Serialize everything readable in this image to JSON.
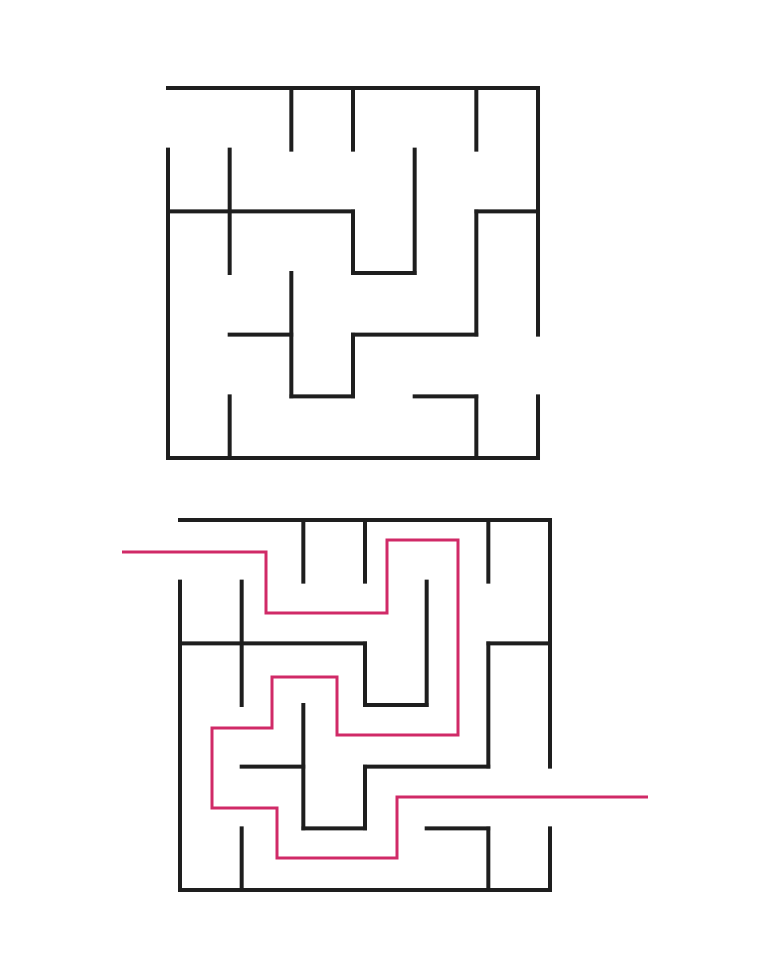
{
  "canvas": {
    "width": 758,
    "height": 980,
    "background": "#ffffff"
  },
  "maze": {
    "grid_cols": 6,
    "grid_rows": 6,
    "cell_size": 61.667,
    "pixel_size": 370,
    "wall_color": "#1e1e1e",
    "wall_width": 4,
    "entrance": "left-side-row-0",
    "exit": "right-side-row-4",
    "walls_grid": [
      [
        0,
        0,
        6,
        0
      ],
      [
        0,
        6,
        6,
        6
      ],
      [
        0,
        1,
        0,
        6
      ],
      [
        6,
        0,
        6,
        4
      ],
      [
        6,
        5,
        6,
        6
      ],
      [
        2,
        0,
        2,
        1
      ],
      [
        3,
        0,
        3,
        1
      ],
      [
        5,
        0,
        5,
        1
      ],
      [
        1,
        1,
        1,
        3
      ],
      [
        4,
        1,
        4,
        3
      ],
      [
        3,
        2,
        3,
        3
      ],
      [
        5,
        2,
        5,
        4
      ],
      [
        2,
        3,
        2,
        5
      ],
      [
        3,
        4,
        3,
        5
      ],
      [
        1,
        5,
        1,
        6
      ],
      [
        5,
        5,
        5,
        6
      ],
      [
        0,
        2,
        3,
        2
      ],
      [
        5,
        2,
        6,
        2
      ],
      [
        3,
        3,
        4,
        3
      ],
      [
        1,
        4,
        2,
        4
      ],
      [
        3,
        4,
        5,
        4
      ],
      [
        2,
        5,
        3,
        5
      ],
      [
        4,
        5,
        5,
        5
      ]
    ]
  },
  "mazes": {
    "unsolved": {
      "origin_x": 168,
      "origin_y": 88
    },
    "solved": {
      "origin_x": 180,
      "origin_y": 520
    }
  },
  "solution": {
    "color": "#d02a67",
    "width": 3,
    "points": [
      [
        122,
        552
      ],
      [
        266,
        552
      ],
      [
        266,
        613
      ],
      [
        387,
        613
      ],
      [
        387,
        540
      ],
      [
        458,
        540
      ],
      [
        458,
        735
      ],
      [
        337,
        735
      ],
      [
        337,
        677
      ],
      [
        272,
        677
      ],
      [
        272,
        728
      ],
      [
        212,
        728
      ],
      [
        212,
        808
      ],
      [
        277,
        808
      ],
      [
        277,
        858
      ],
      [
        397,
        858
      ],
      [
        397,
        797
      ],
      [
        648,
        797
      ]
    ]
  }
}
